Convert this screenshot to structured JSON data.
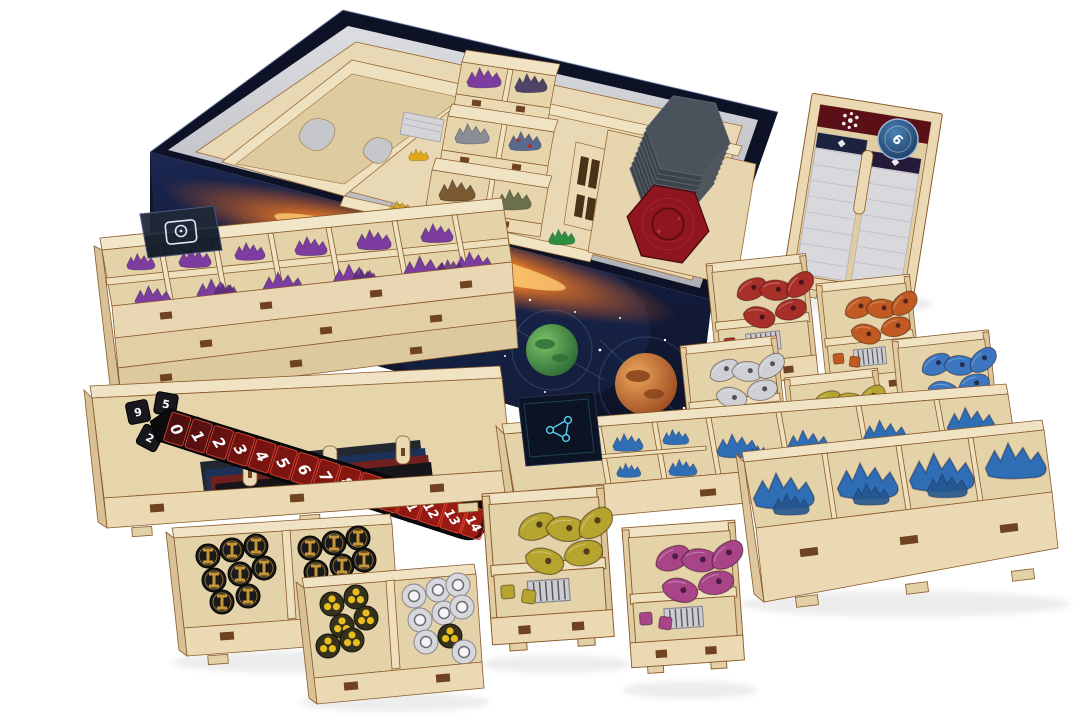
{
  "scene": {
    "description": "Product photo of a laser-cut plywood board game organizer: the game box with insert plus many wooden trays filled with components",
    "background_color": "#ffffff"
  },
  "box": {
    "shell_color": "#10172b",
    "rim_color": "#0d1226",
    "interior_color": "#c9cacd",
    "art": {
      "fire_glow_color": "#ef7f26",
      "starfield_color": "#16244a",
      "planet_green_color": "#3f8f4a",
      "planet_orange_color": "#c9682c"
    }
  },
  "wood": {
    "face_color": "#ead9b3",
    "floor_color": "#e4d2a9",
    "edge_color": "#8a5a2b",
    "slot_color": "#6f431f"
  },
  "victory_track": {
    "numbers": [
      "0",
      "1",
      "2",
      "3",
      "4",
      "5",
      "6",
      "7",
      "8",
      "9",
      "10",
      "11",
      "12",
      "13",
      "14"
    ],
    "strip_color": "#0b0b0d",
    "cell_color": "#8c1512",
    "cell_border_color": "#e2483a",
    "number_color": "#ffffff"
  },
  "dice": {
    "color": "#17171c",
    "pip_color": "#ffffff",
    "visible_faces": [
      "9",
      "5",
      "2",
      "6"
    ]
  },
  "card_holder": {
    "disc_label": "6",
    "disc_color": "#2c5f92",
    "top_strip_color": "#5a1016",
    "card_stack_color": "#d9d9dd"
  },
  "components": {
    "purple_units_color": "#7d3da0",
    "blue_ships_color": "#2f6db5",
    "trade_coin_colors": {
      "base": "#1a1a1a",
      "accent": "#c8963a"
    },
    "trefoil_token_colors": {
      "base": "#34311c",
      "accent": "#e8bd1f"
    },
    "ring_token_color": "#d8d8dc",
    "faction_token_colors": {
      "red": "#a93029",
      "orange": "#c05a22",
      "white": "#cfd0d6",
      "yellow_green": "#b5a42e",
      "blue": "#3c76c0",
      "magenta": "#a84487"
    },
    "hex_tile_stack_color": "#3d434b",
    "hex_tile_face_color": "#8f1620"
  },
  "trays": [
    {
      "id": "game-box",
      "label": "Game box with wooden insert, hex tile stack and stacked token trays"
    },
    {
      "id": "card-holder-tray",
      "label": "Card holder with sleeved card stacks and round tokens"
    },
    {
      "id": "purple-units-tray",
      "label": "Purple plastic units tray with card deck"
    },
    {
      "id": "victory-track-tray",
      "label": "Score track, dice and player sheets tray"
    },
    {
      "id": "trade-goods-tray",
      "label": "Black and gold coin tokens tray"
    },
    {
      "id": "round-tokens-tray",
      "label": "Trefoil and ring tokens tray"
    },
    {
      "id": "faction-tray-red",
      "label": "Red tokens tray"
    },
    {
      "id": "faction-tray-orange",
      "label": "Orange tokens tray"
    },
    {
      "id": "faction-tray-white",
      "label": "White tokens tray"
    },
    {
      "id": "faction-tray-yellow-right",
      "label": "Yellow-green tokens tray (right)"
    },
    {
      "id": "faction-tray-blue",
      "label": "Blue tokens tray"
    },
    {
      "id": "faction-tray-yellow-front",
      "label": "Yellow-green tokens tray (front)"
    },
    {
      "id": "faction-tray-magenta",
      "label": "Magenta tokens tray"
    },
    {
      "id": "blue-ships-tray",
      "label": "Blue plastic ships tray with tech deck"
    },
    {
      "id": "large-ships-tray",
      "label": "Large blue ships tray"
    }
  ]
}
